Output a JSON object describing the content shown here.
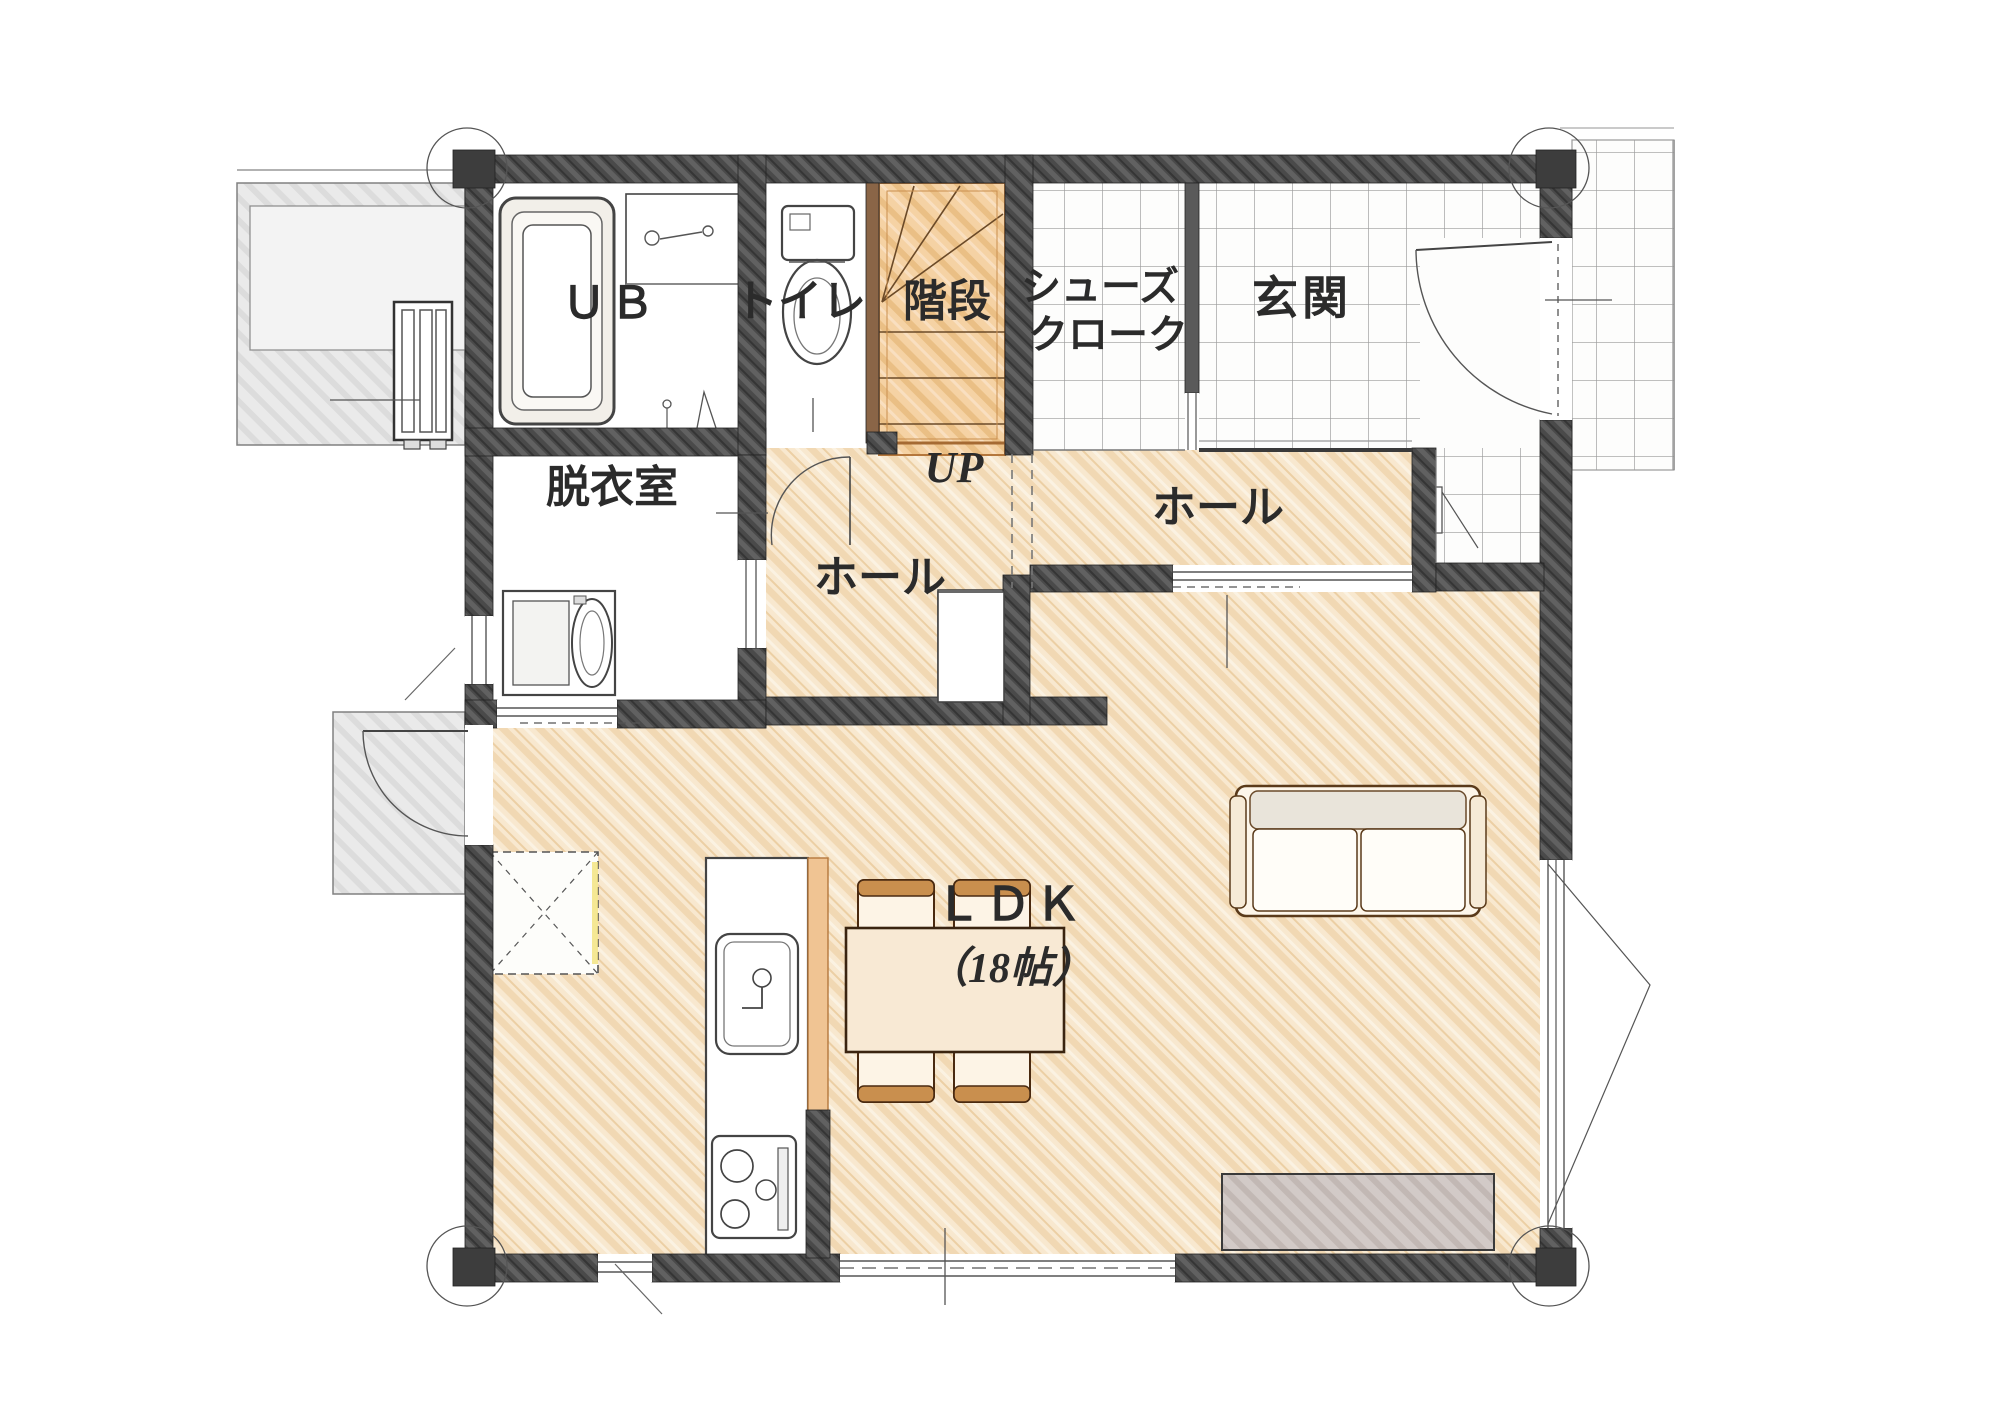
{
  "floorplan": {
    "rooms": [
      {
        "id": "ub",
        "label": "ＵＢ"
      },
      {
        "id": "toilet",
        "label": "トイレ"
      },
      {
        "id": "stairs",
        "label": "階段"
      },
      {
        "id": "shoes-cloak",
        "label_line1": "シューズ",
        "label_line2": "クローク"
      },
      {
        "id": "genkan",
        "label": "玄関"
      },
      {
        "id": "hall-entrance",
        "label": "ホール"
      },
      {
        "id": "hall-center",
        "label": "ホール"
      },
      {
        "id": "dressing-room",
        "label": "脱衣室"
      },
      {
        "id": "ldk",
        "label": "ＬＤＫ",
        "size": "（18帖）"
      }
    ],
    "annotations": {
      "stairs_up": "UP"
    },
    "fixtures": [
      "bathtub",
      "vanity-counter",
      "toilet-fixture",
      "washing-machine",
      "kitchen-sink",
      "gas-cooktop",
      "floor-hatch",
      "hall-closet",
      "shoe-cabinet",
      "dining-table",
      "dining-chair",
      "sofa",
      "tv-board",
      "outdoor-unit",
      "entrance-door",
      "stairs"
    ],
    "colors": {
      "wood_floor": "#f6e4c8",
      "stair_floor": "#f3cfa2",
      "wall": "#4a4a4a",
      "tile_line": "#909090",
      "exterior_concrete": "#e9e9e9",
      "wood_trim": "#b5773c"
    }
  }
}
